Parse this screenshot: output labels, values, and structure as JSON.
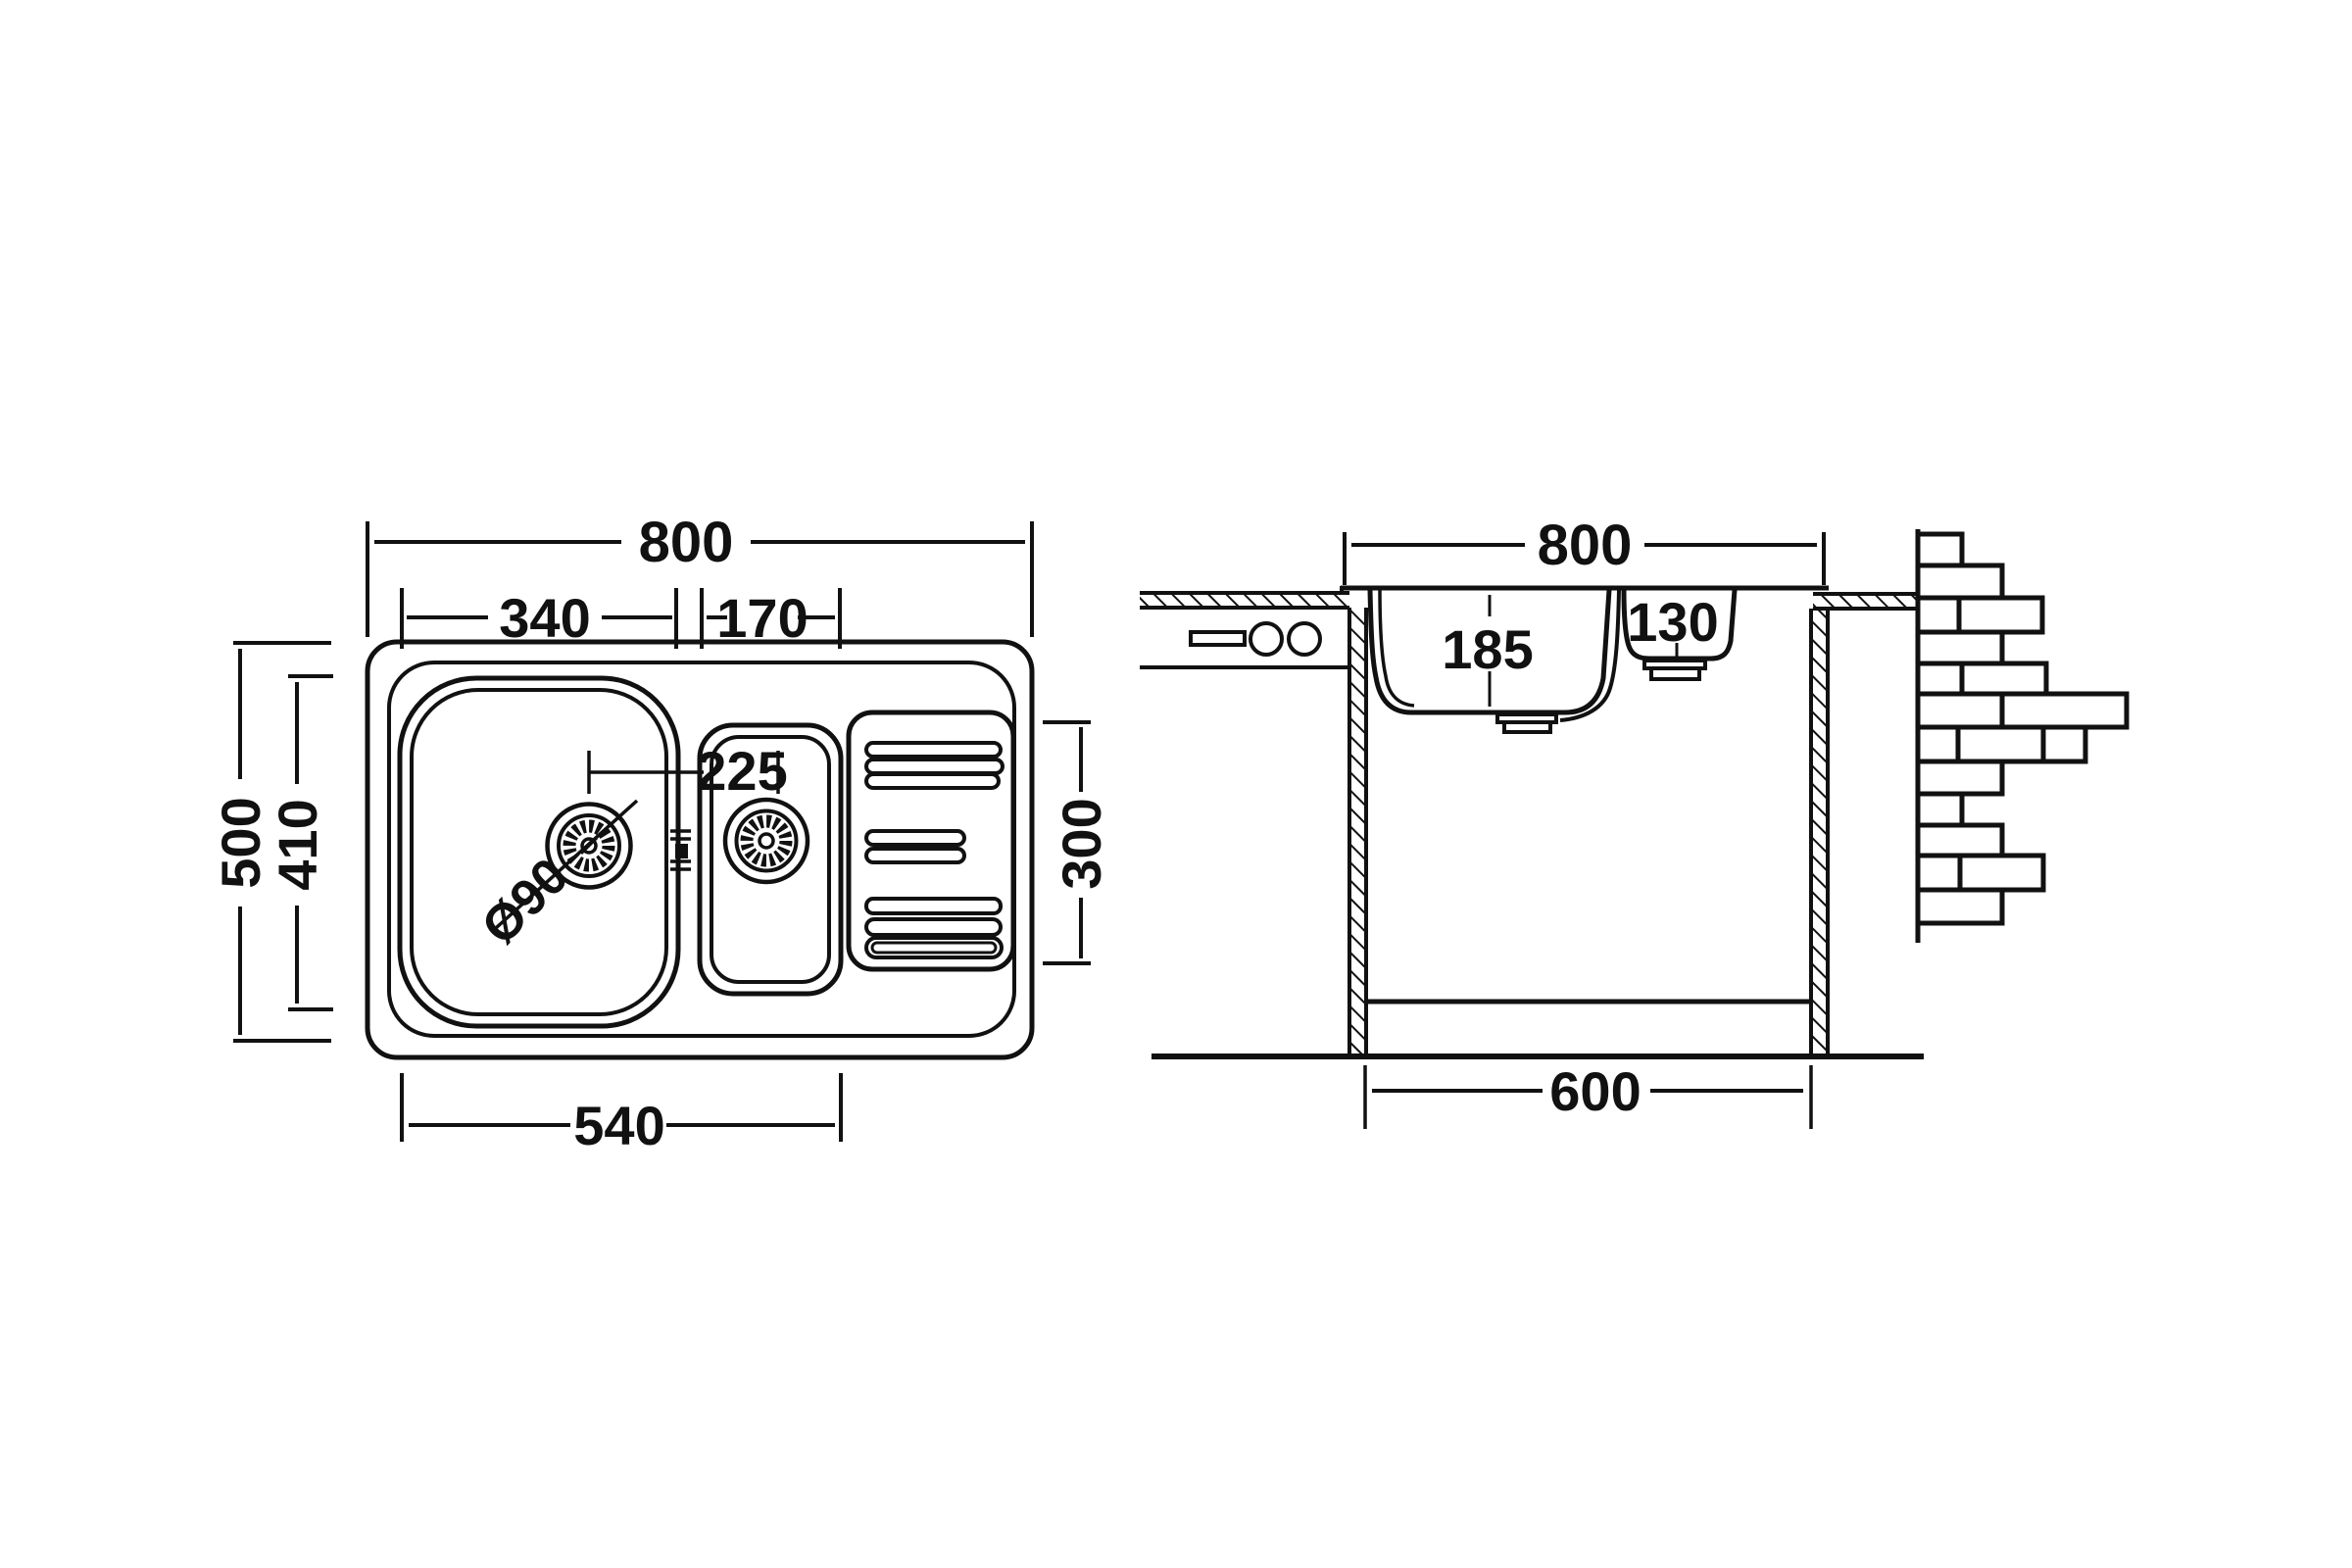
{
  "plan": {
    "overall_width": "800",
    "main_bowl_width": "340",
    "small_bowl_width": "170",
    "overall_depth": "500",
    "bowl_length": "410",
    "bowl_zone_width": "540",
    "drainer_length": "300",
    "drain_offset": "225",
    "drain_diameter": "Ø90"
  },
  "section": {
    "overall_width": "800",
    "main_bowl_depth": "185",
    "small_bowl_depth": "130",
    "cabinet_width": "600"
  }
}
